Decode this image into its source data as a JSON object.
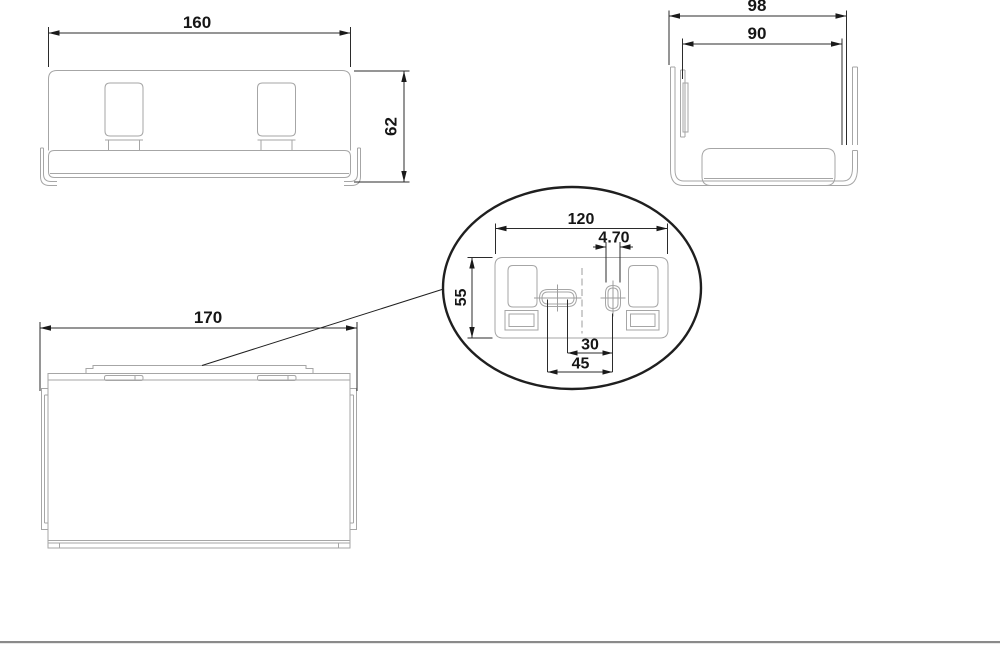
{
  "drawing": {
    "front_view": {
      "width_dim": "160",
      "height_dim": "62"
    },
    "side_view": {
      "outer_width_dim": "98",
      "inner_width_dim": "90"
    },
    "top_view": {
      "width_dim": "170"
    },
    "detail_view": {
      "plate_width_dim": "120",
      "slot_width_dim": "4.70",
      "plate_height_dim": "55",
      "slot_offset_inner_dim": "30",
      "slot_offset_outer_dim": "45"
    },
    "colors": {
      "part_line": "#a6a6a6",
      "dimension_line": "#2b2b2b",
      "text": "#161616"
    }
  }
}
